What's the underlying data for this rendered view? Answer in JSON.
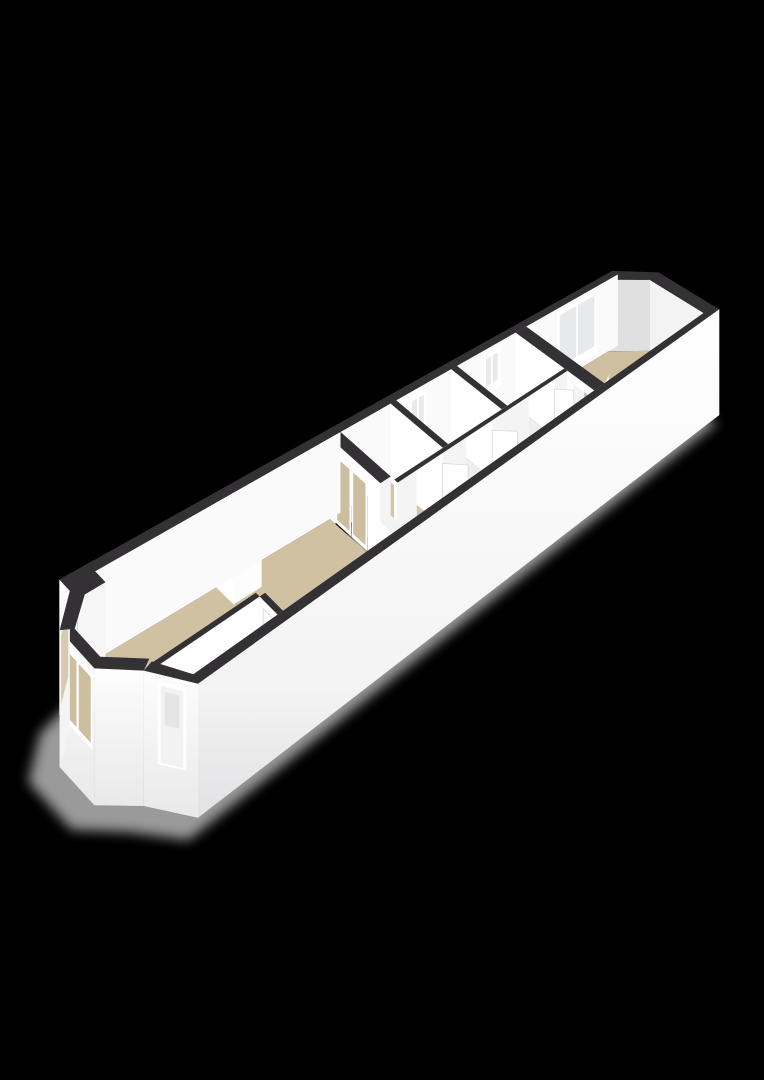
{
  "canvas": {
    "width": 764,
    "height": 1080,
    "background": "#000000"
  },
  "scene": {
    "type": "3d-floorplan",
    "view": "axonometric-from-southwest",
    "rooms": [
      {
        "name": "living-room",
        "floor": "wood"
      },
      {
        "name": "entrance-hall",
        "floor": "light"
      },
      {
        "name": "landing",
        "floor": "wood"
      },
      {
        "name": "bathroom",
        "floor": "light"
      },
      {
        "name": "toilet",
        "floor": "light"
      },
      {
        "name": "corridor",
        "floor": "light"
      },
      {
        "name": "bedroom",
        "floor": "wood"
      }
    ],
    "features": [
      "bay-window-front",
      "bay-window-side",
      "front-door",
      "notched-left-wall",
      "chimney-breast",
      "french-doors",
      "living-room-door",
      "interior-doors",
      "corridor-window",
      "toilet-window",
      "bedroom-window",
      "angled-rear-corner",
      "drop-shadow"
    ]
  },
  "colors": {
    "background": "#000000",
    "shadow": "#b5b5b5",
    "wall_top": "#343135",
    "wall_inner": "#f4f4f5",
    "wall_inner_lit": "#ffffff",
    "wall_inner_soft": "#fafafb",
    "wall_inner_shaded": "#e0e0e1",
    "outer_top": "#ffffff",
    "outer_bottom": "#e7e7e8",
    "floor_wood": "#cfc1a2",
    "floor_wood_deep": "#cdbfa0",
    "floor_wood_landing": "#d3c5a8",
    "floor_light": "#eef0f1",
    "floor_light2": "#eceef0",
    "glass": "#e7e9eb",
    "glass_interior": "#ccbe9f",
    "frame": "#ffffff",
    "leaf": "#f2f2f2",
    "leaf_inset": "#e5e5e6",
    "threshold": "#d8b88a",
    "chimney_inner": "#e9e9ea",
    "chimney_shade": "#c9c9ca",
    "door_edge": "#d8d8d8",
    "handle": "#9a9a9a"
  }
}
